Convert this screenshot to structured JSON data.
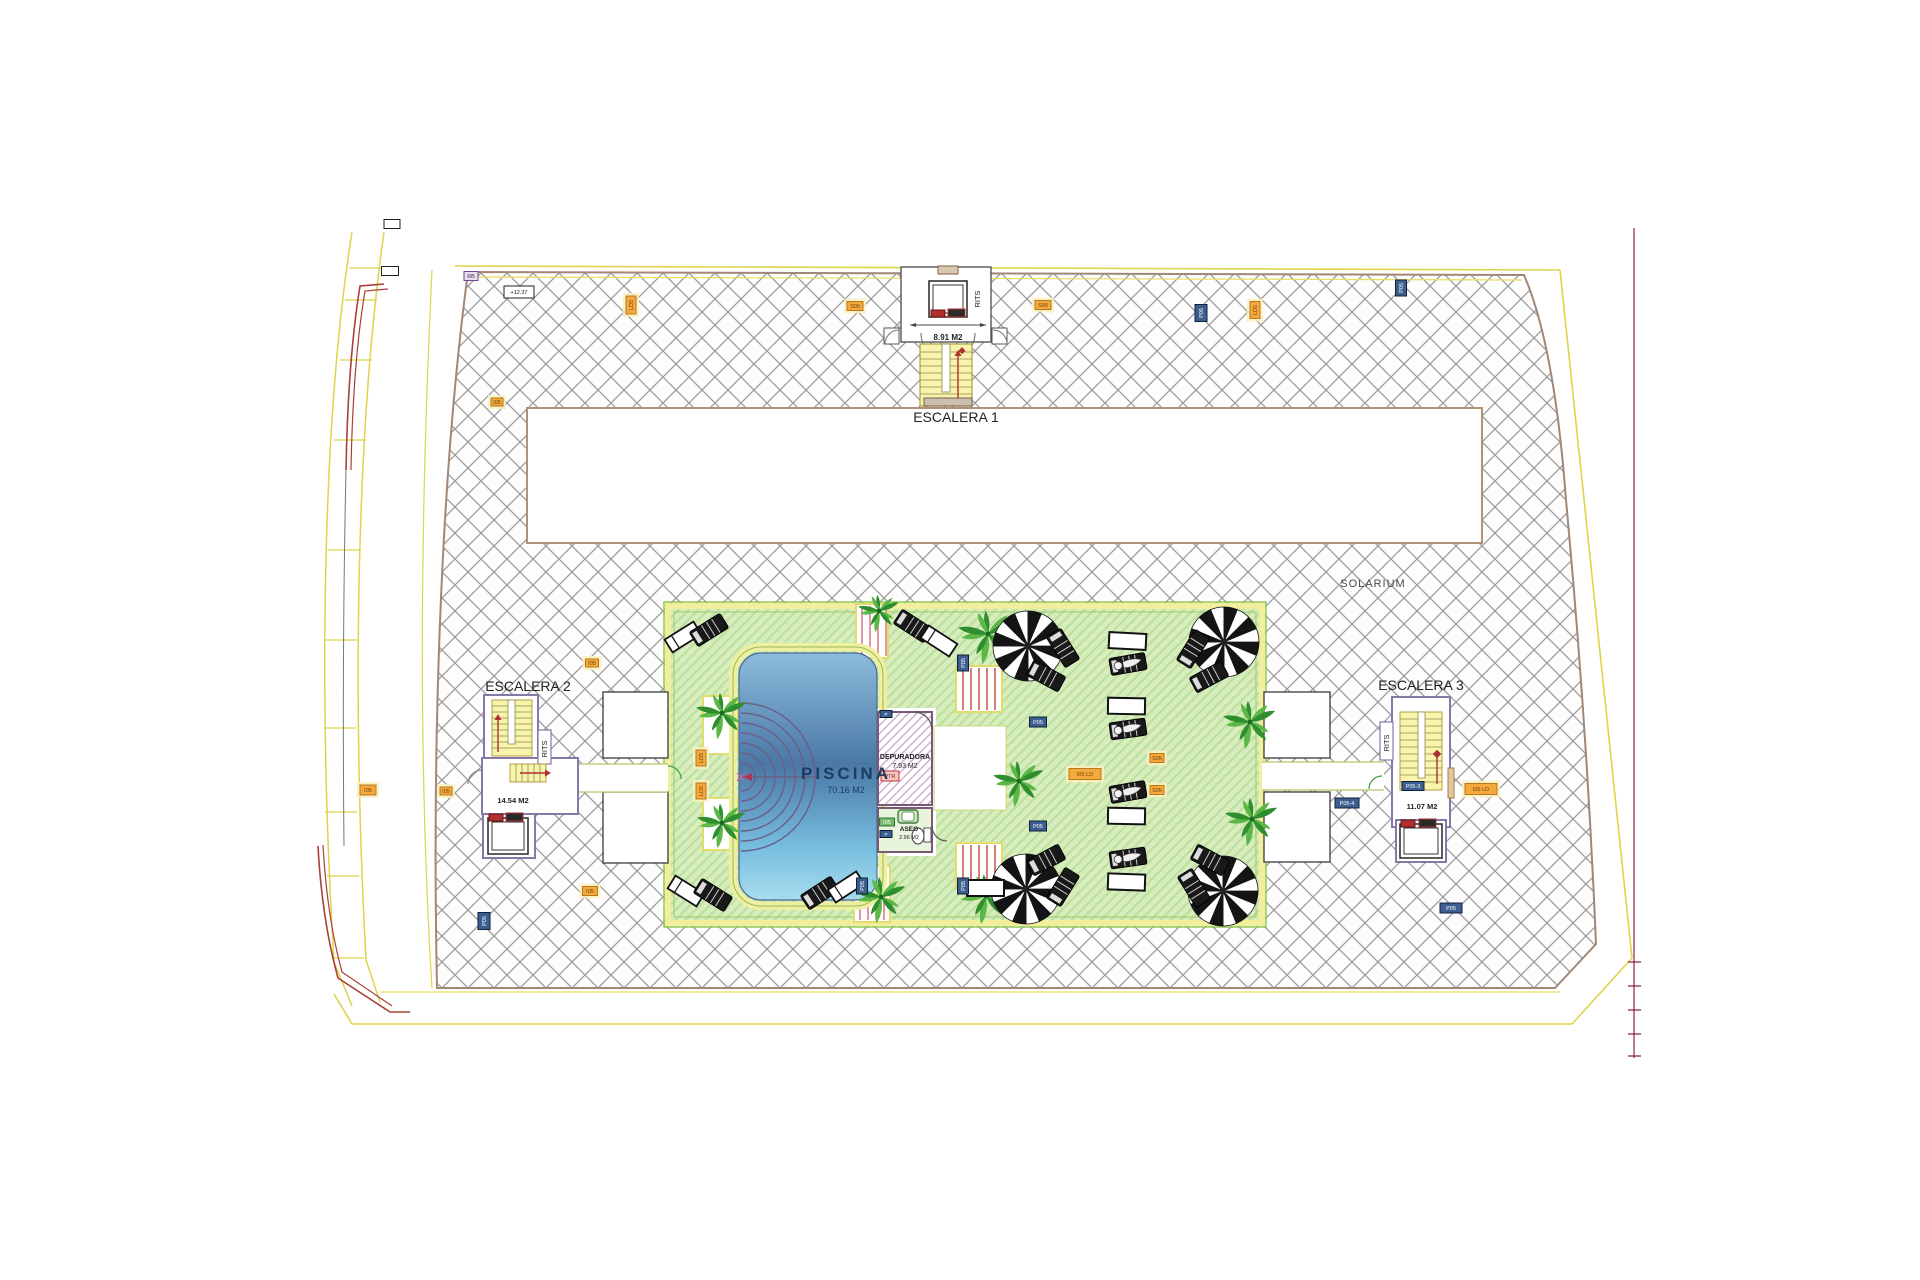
{
  "plan": {
    "solarium": "SOLARIUM",
    "rits": "RITS",
    "escalera1": {
      "name": "ESCALERA 1",
      "area": "8.91 M2"
    },
    "escalera2": {
      "name": "ESCALERA 2",
      "area": "14.54 M2"
    },
    "escalera3": {
      "name": "ESCALERA 3",
      "area": "11.07 M2"
    },
    "piscina": {
      "name": "PISCINA",
      "area": "70.16 M2"
    },
    "depuradora": {
      "name": "DEPURADORA",
      "area": "7.93 M2"
    },
    "aseo": {
      "name": "ASEO",
      "area": "2.96 M2"
    }
  },
  "colors": {
    "hatch_line": "#9b9b9b",
    "slab_border": "#a08878",
    "boundary_yellow": "#ddd44a",
    "deck_green": "#d8edbe",
    "deck_stripe": "#bce09e",
    "deck_border_green": "#8bc34a",
    "deck_border_yellow": "#f2ef9c",
    "pool_top": "#8cbcdc",
    "pool_mid": "#4a77a6",
    "pool_bottom": "#a8dcee",
    "stair_yellow": "#f8f4ac",
    "red_accent": "#b03030",
    "palm_dark": "#2f8f2f",
    "palm_light": "#5cb846",
    "markers": {
      "orange": {
        "f": "#f5a93c",
        "s": "#b5791e",
        "t": "#6b3f0c",
        "halo": "#fbf0c0"
      },
      "blue": {
        "f": "#3d5f8f",
        "s": "#101f3a",
        "t": "#ffffff"
      },
      "red": {
        "f": "#f3c6c0",
        "s": "#c03636",
        "t": "#8c1f1f"
      },
      "green": {
        "f": "#74b868",
        "s": "#2f7a33",
        "t": "#ffffff"
      },
      "black": {
        "f": "#ffffff",
        "s": "#222222",
        "t": "#111111"
      },
      "purple": {
        "f": "#e8e0f0",
        "s": "#6a4a8a",
        "t": "#3a2a5a"
      }
    }
  },
  "markers": [
    {
      "x": 855,
      "y": 306,
      "w": 16,
      "h": 9,
      "c": "orange",
      "t": "S05"
    },
    {
      "x": 1043,
      "y": 305,
      "w": 16,
      "h": 9,
      "c": "orange",
      "t": "S05"
    },
    {
      "x": 631,
      "y": 305,
      "w": 18,
      "h": 10,
      "c": "orange",
      "t": "LD5",
      "v": true
    },
    {
      "x": 497,
      "y": 402,
      "w": 12,
      "h": 8,
      "c": "orange",
      "t": "I05"
    },
    {
      "x": 519,
      "y": 292,
      "w": 30,
      "h": 12,
      "c": "black",
      "t": "+12.37"
    },
    {
      "x": 471,
      "y": 276,
      "w": 14,
      "h": 9,
      "c": "purple",
      "t": "RB"
    },
    {
      "x": 1201,
      "y": 313,
      "w": 17,
      "h": 12,
      "c": "blue",
      "t": "P05",
      "v": true
    },
    {
      "x": 1255,
      "y": 310,
      "w": 17,
      "h": 10,
      "c": "orange",
      "t": "LD5",
      "v": true
    },
    {
      "x": 1401,
      "y": 288,
      "w": 16,
      "h": 11,
      "c": "blue",
      "t": "P05",
      "v": true
    },
    {
      "x": 590,
      "y": 891,
      "w": 15,
      "h": 9,
      "c": "orange",
      "t": "I05"
    },
    {
      "x": 484,
      "y": 921,
      "w": 17,
      "h": 12,
      "c": "blue",
      "t": "P05",
      "v": true
    },
    {
      "x": 1451,
      "y": 908,
      "w": 22,
      "h": 10,
      "c": "blue",
      "t": "P05"
    },
    {
      "x": 1085,
      "y": 774,
      "w": 32,
      "h": 11,
      "c": "orange",
      "t": "I05 LD"
    },
    {
      "x": 1157,
      "y": 758,
      "w": 14,
      "h": 9,
      "c": "orange",
      "t": "S05"
    },
    {
      "x": 1157,
      "y": 790,
      "w": 14,
      "h": 9,
      "c": "orange",
      "t": "S05"
    },
    {
      "x": 1038,
      "y": 722,
      "w": 17,
      "h": 10,
      "c": "blue",
      "t": "P05"
    },
    {
      "x": 1038,
      "y": 826,
      "w": 17,
      "h": 10,
      "c": "blue",
      "t": "P05"
    },
    {
      "x": 1413,
      "y": 786,
      "w": 22,
      "h": 9,
      "c": "blue",
      "t": "P05-3"
    },
    {
      "x": 1481,
      "y": 789,
      "w": 32,
      "h": 11,
      "c": "orange",
      "t": "I05 LD"
    },
    {
      "x": 1347,
      "y": 803,
      "w": 24,
      "h": 10,
      "c": "blue",
      "t": "P05-4"
    },
    {
      "x": 701,
      "y": 758,
      "w": 16,
      "h": 10,
      "c": "orange",
      "t": "LD5",
      "v": true
    },
    {
      "x": 701,
      "y": 791,
      "w": 16,
      "h": 10,
      "c": "orange",
      "t": "LD5",
      "v": true
    },
    {
      "x": 890,
      "y": 776,
      "w": 18,
      "h": 10,
      "c": "red",
      "t": "PTR"
    },
    {
      "x": 887,
      "y": 822,
      "w": 15,
      "h": 8,
      "c": "green",
      "t": "I05"
    },
    {
      "x": 886,
      "y": 834,
      "w": 12,
      "h": 7,
      "c": "blue",
      "t": "P"
    },
    {
      "x": 886,
      "y": 714,
      "w": 12,
      "h": 7,
      "c": "blue",
      "t": "P"
    },
    {
      "x": 862,
      "y": 886,
      "w": 16,
      "h": 11,
      "c": "blue",
      "t": "P05",
      "v": true
    },
    {
      "x": 963,
      "y": 663,
      "w": 16,
      "h": 11,
      "c": "blue",
      "t": "P05",
      "v": true
    },
    {
      "x": 963,
      "y": 886,
      "w": 16,
      "h": 11,
      "c": "blue",
      "t": "P05",
      "v": true
    },
    {
      "x": 592,
      "y": 663,
      "w": 13,
      "h": 8,
      "c": "orange",
      "t": "I05"
    },
    {
      "x": 368,
      "y": 790,
      "w": 16,
      "h": 10,
      "c": "orange",
      "t": "I05"
    },
    {
      "x": 446,
      "y": 791,
      "w": 12,
      "h": 8,
      "c": "orange",
      "t": "I05"
    },
    {
      "x": 392,
      "y": 224,
      "w": 16,
      "h": 9,
      "c": "black",
      "t": ""
    },
    {
      "x": 390,
      "y": 271,
      "w": 17,
      "h": 9,
      "c": "black",
      "t": ""
    }
  ],
  "palms": [
    {
      "x": 722,
      "y": 713,
      "r": 26
    },
    {
      "x": 722,
      "y": 823,
      "r": 25
    },
    {
      "x": 879,
      "y": 611,
      "r": 21
    },
    {
      "x": 881,
      "y": 897,
      "r": 26
    },
    {
      "x": 988,
      "y": 634,
      "r": 30
    },
    {
      "x": 986,
      "y": 896,
      "r": 28
    },
    {
      "x": 1019,
      "y": 781,
      "r": 26
    },
    {
      "x": 1250,
      "y": 722,
      "r": 27
    },
    {
      "x": 1252,
      "y": 819,
      "r": 27
    }
  ],
  "parasols": [
    {
      "x": 1028,
      "y": 646,
      "r": 35
    },
    {
      "x": 1224,
      "y": 642,
      "r": 35
    },
    {
      "x": 1026,
      "y": 889,
      "r": 35
    },
    {
      "x": 1223,
      "y": 891,
      "r": 35
    }
  ],
  "loungers": [
    {
      "x": 683,
      "y": 637,
      "a": -32,
      "t": "white"
    },
    {
      "x": 709,
      "y": 630,
      "a": -32,
      "t": "dark"
    },
    {
      "x": 913,
      "y": 626,
      "a": 33,
      "t": "dark"
    },
    {
      "x": 939,
      "y": 641,
      "a": 33,
      "t": "white"
    },
    {
      "x": 686,
      "y": 891,
      "a": 32,
      "t": "white"
    },
    {
      "x": 713,
      "y": 895,
      "a": 32,
      "t": "dark"
    },
    {
      "x": 820,
      "y": 893,
      "a": -33,
      "t": "dark"
    },
    {
      "x": 846,
      "y": 887,
      "a": -33,
      "t": "white"
    },
    {
      "x": 1063,
      "y": 648,
      "a": 58,
      "t": "dark"
    },
    {
      "x": 1046,
      "y": 676,
      "a": 28,
      "t": "dark"
    },
    {
      "x": 1193,
      "y": 649,
      "a": -58,
      "t": "dark"
    },
    {
      "x": 1209,
      "y": 677,
      "a": -28,
      "t": "dark"
    },
    {
      "x": 1063,
      "y": 887,
      "a": -58,
      "t": "dark"
    },
    {
      "x": 1046,
      "y": 860,
      "a": -28,
      "t": "dark"
    },
    {
      "x": 1194,
      "y": 888,
      "a": 58,
      "t": "dark"
    },
    {
      "x": 1210,
      "y": 860,
      "a": 28,
      "t": "dark"
    },
    {
      "x": 1127,
      "y": 641,
      "a": 3,
      "t": "table"
    },
    {
      "x": 1128,
      "y": 664,
      "a": -10,
      "t": "figure"
    },
    {
      "x": 1126,
      "y": 706,
      "a": 1,
      "t": "table"
    },
    {
      "x": 1128,
      "y": 729,
      "a": -8,
      "t": "figure"
    },
    {
      "x": 1128,
      "y": 792,
      "a": -10,
      "t": "figure"
    },
    {
      "x": 1126,
      "y": 816,
      "a": 1,
      "t": "table"
    },
    {
      "x": 1128,
      "y": 858,
      "a": -8,
      "t": "figure"
    },
    {
      "x": 1126,
      "y": 882,
      "a": 2,
      "t": "table"
    },
    {
      "x": 985,
      "y": 888,
      "a": 0,
      "t": "table"
    }
  ]
}
